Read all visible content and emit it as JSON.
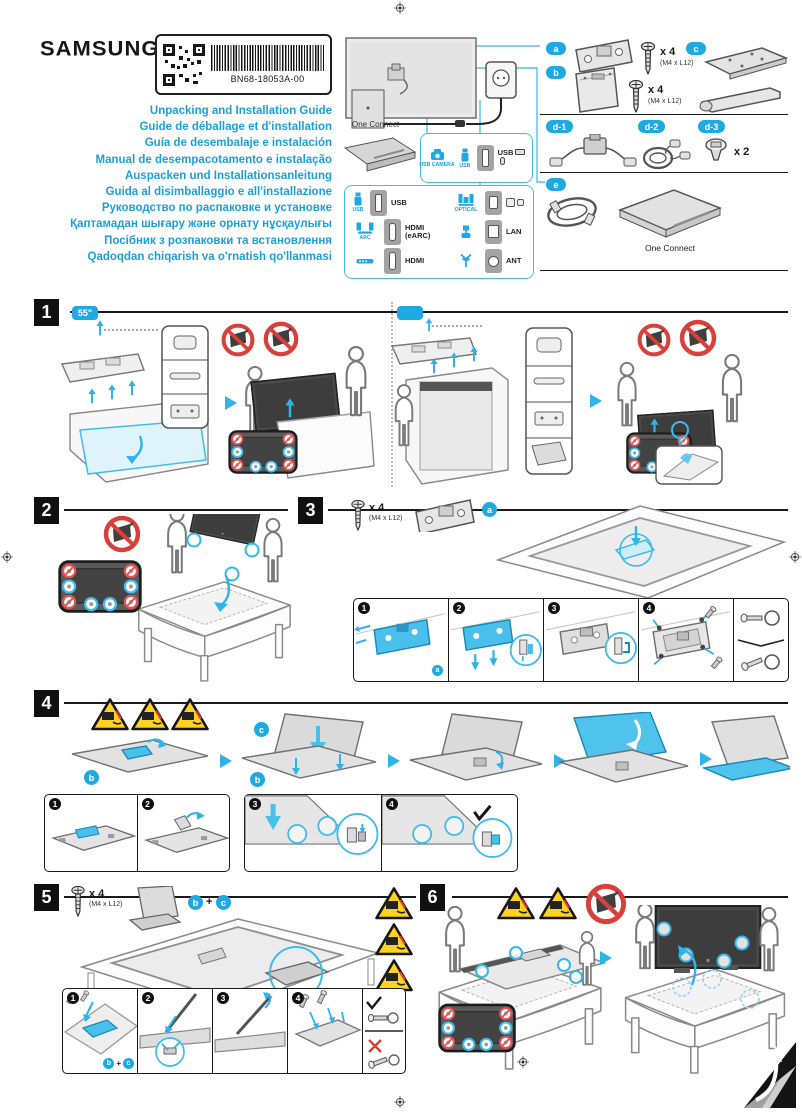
{
  "page": {
    "brand": "SAMSUNG",
    "part_number": "BN68-18053A-00",
    "titles": [
      "Unpacking and Installation Guide",
      "Guide de déballage et d'installation",
      "Guía de desembalaje e instalación",
      "Manual de desempacotamento e instalação",
      "Auspacken und Installationsanleitung",
      "Guida al disimballaggio e all'installazione",
      "Руководство по распаковке и установке",
      "Қаптамадан шығару және орнату нұсқаулығы",
      "Посібник з розпаковки та встановлення",
      "Qadoqdan chiqarish va o'rnatish qo'llanmasi"
    ]
  },
  "hookup": {
    "one_connect_label": "One Connect",
    "camera_panel": {
      "usb_camera_label": "USB CAMERA",
      "usb_label": "USB",
      "port_label": "USB"
    },
    "ports": {
      "usb_source_label": "USB",
      "usb_port_label": "USB",
      "optical_source_label": "OPTICAL",
      "arc_source_label": "ARC",
      "hdmi_earc_port_label": "HDMI (eARC)",
      "lan_port_label": "LAN",
      "hdmi_port_label": "HDMI",
      "ant_port_label": "ANT"
    }
  },
  "parts": {
    "a_label": "a",
    "b_label": "b",
    "c_label": "c",
    "d1_label": "d-1",
    "d2_label": "d-2",
    "d3_label": "d-3",
    "e_label": "e",
    "screw_qty": "x 4",
    "screw_spec": "(M4 x L12)",
    "d3_qty": "x 2",
    "one_connect_caption": "One Connect"
  },
  "sections": {
    "s1": {
      "num": "1",
      "size_badge": "55\""
    },
    "s2": {
      "num": "2"
    },
    "s3": {
      "num": "3",
      "screw_qty": "x 4",
      "screw_spec": "(M4 x L12)",
      "part_a": "a",
      "steps": [
        "1",
        "2",
        "3",
        "4"
      ]
    },
    "s4": {
      "num": "4",
      "part_b": "b",
      "part_c": "c",
      "steps": [
        "1",
        "2",
        "3",
        "4"
      ]
    },
    "s5": {
      "num": "5",
      "screw_qty": "x 4",
      "screw_spec": "(M4 x L12)",
      "part_b": "b",
      "plus": "+",
      "part_c": "c",
      "steps": [
        "1",
        "2",
        "3",
        "4"
      ]
    },
    "s6": {
      "num": "6"
    }
  },
  "colors": {
    "accent": "#1FA9E2",
    "warning_yellow": "#FFD21E",
    "prohibition_red": "#D8403C",
    "badge_black": "#141414"
  }
}
